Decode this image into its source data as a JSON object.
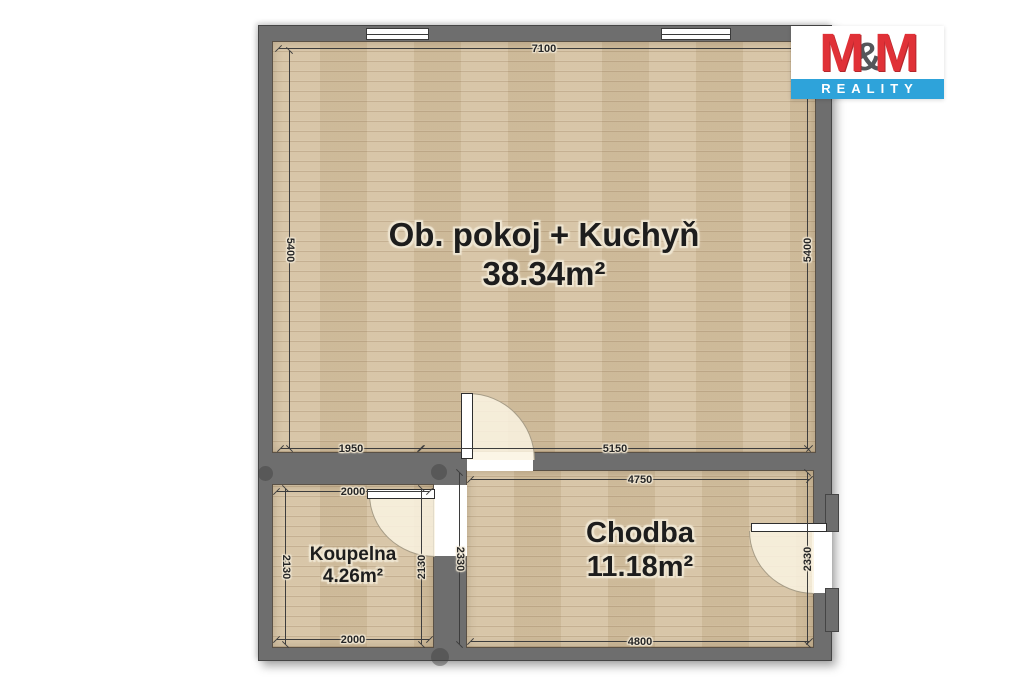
{
  "brand": {
    "m1": "M",
    "amp": "&",
    "m2": "M",
    "subtitle": "REALITY",
    "red": "#e03137",
    "blue": "#2ea3da"
  },
  "rooms": {
    "living": {
      "name": "Ob. pokoj + Kuchyň",
      "area": "38.34m²"
    },
    "hallway": {
      "name": "Chodba",
      "area": "11.18m²"
    },
    "bathroom": {
      "name": "Koupelna",
      "area": "4.26m²"
    }
  },
  "dimensions": {
    "living_top": "7100",
    "living_left": "5400",
    "living_right": "5400",
    "living_bottom_left": "1950",
    "living_bottom_right": "5150",
    "hallway_top": "4750",
    "hallway_bottom": "4800",
    "hallway_left": "2330",
    "hallway_right": "2330",
    "bathroom_top": "2000",
    "bathroom_bottom": "2000",
    "bathroom_left": "2130",
    "bathroom_right": "2130"
  },
  "colors": {
    "wall": "#6e6e6e",
    "floor": "#d5c2a2",
    "background": "#ffffff",
    "dimension_line": "#3d3d3d",
    "label_text": "#1d1d1d"
  }
}
